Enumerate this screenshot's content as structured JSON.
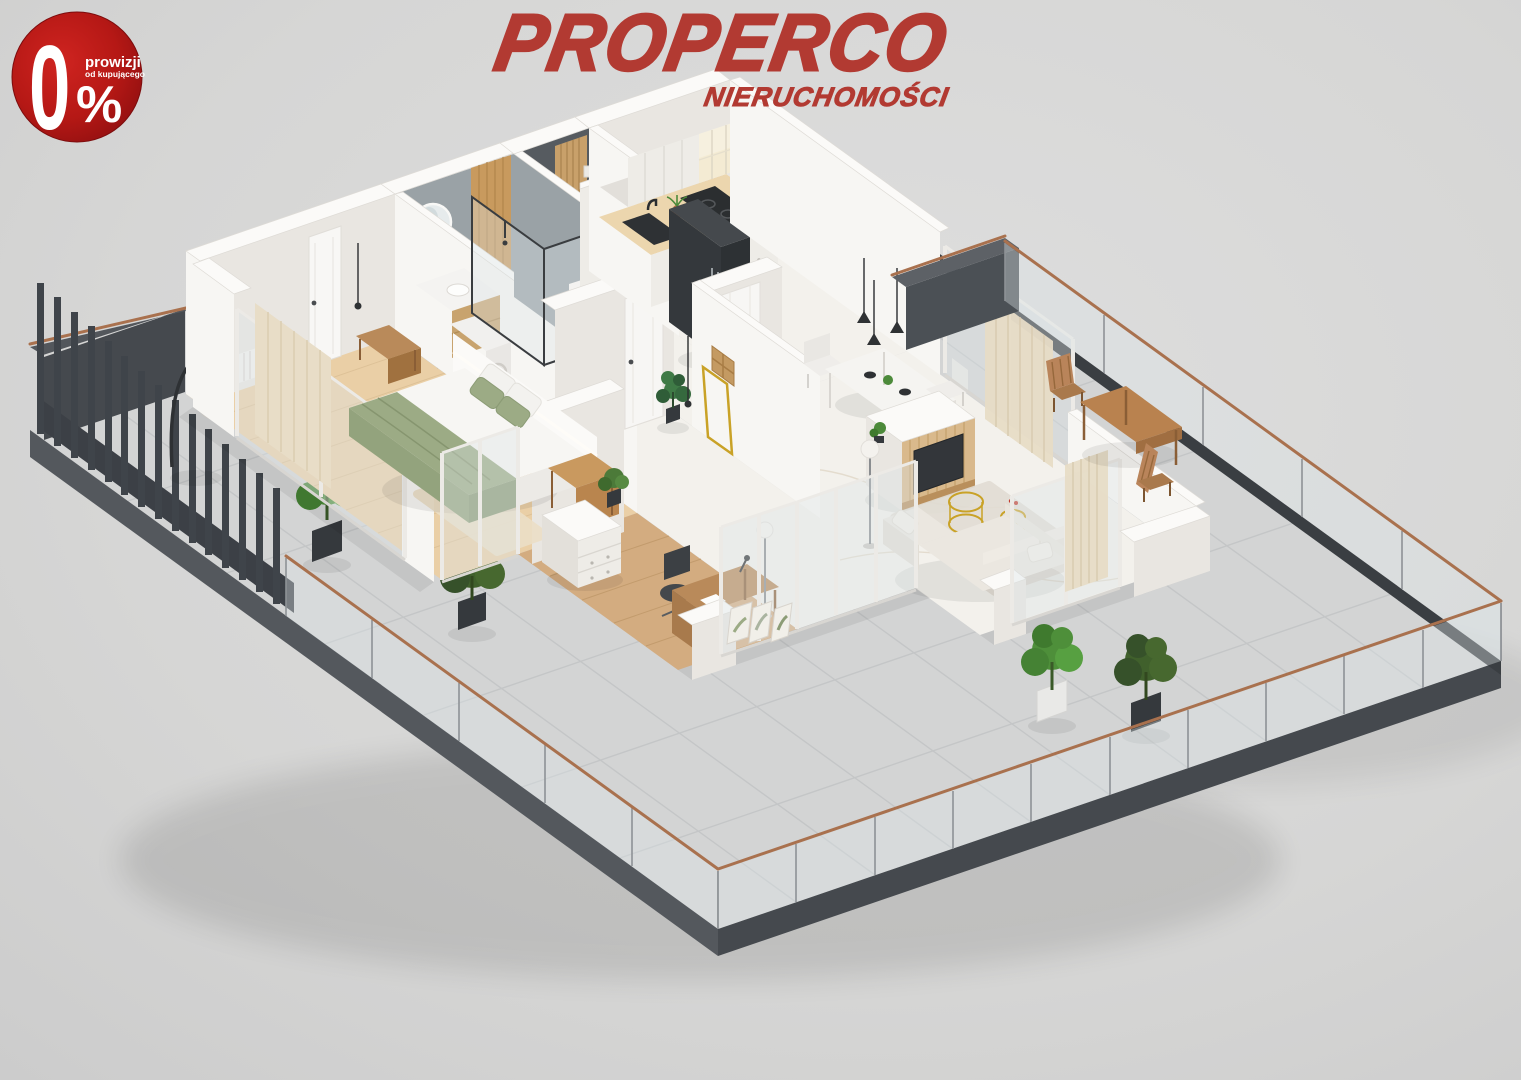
{
  "badge": {
    "zero": "0",
    "percent_sign": "%",
    "line1": "prowizji",
    "line2": "od kupującego"
  },
  "logo": {
    "title": "PROPERCO",
    "subtitle": "NIERUCHOMOŚCI"
  },
  "colors": {
    "background": "#d7d7d6",
    "badge_red": "#bf1b18",
    "badge_red_dark": "#8c0e10",
    "brand_red": "#b23a32",
    "fascia_dark": "#45494e",
    "slat_dark": "#3f444a",
    "copper_rail": "#a9714e",
    "glass_tint": "rgba(220,228,232,0.38)",
    "tile": "#d3d4d4",
    "tile_grout": "#c2c4c5",
    "wall_bright": "#f7f6f3",
    "wall_shade": "#e9e6e1",
    "wall_top": "#fbfaf8",
    "marble_floor": "#f3f1ec",
    "wood_floor": "#eacfa6",
    "office_wood": "#d3ac80",
    "bath_floor": "#b0b5b7",
    "bath_wall": "#9aa2a6",
    "kitchen_wood": "#ecd6ae",
    "cabinet_white": "#eeece7",
    "appliance_dark": "#35393d",
    "sage_green": "#9cab85",
    "sofa_cream": "#ebe7e0",
    "tv_wood": "#d9b98c",
    "gold_brass": "#c9a227",
    "plant_green": "#4e8f3a",
    "plant_olive": "#40602c",
    "furniture_wood": "#b98a5a"
  }
}
